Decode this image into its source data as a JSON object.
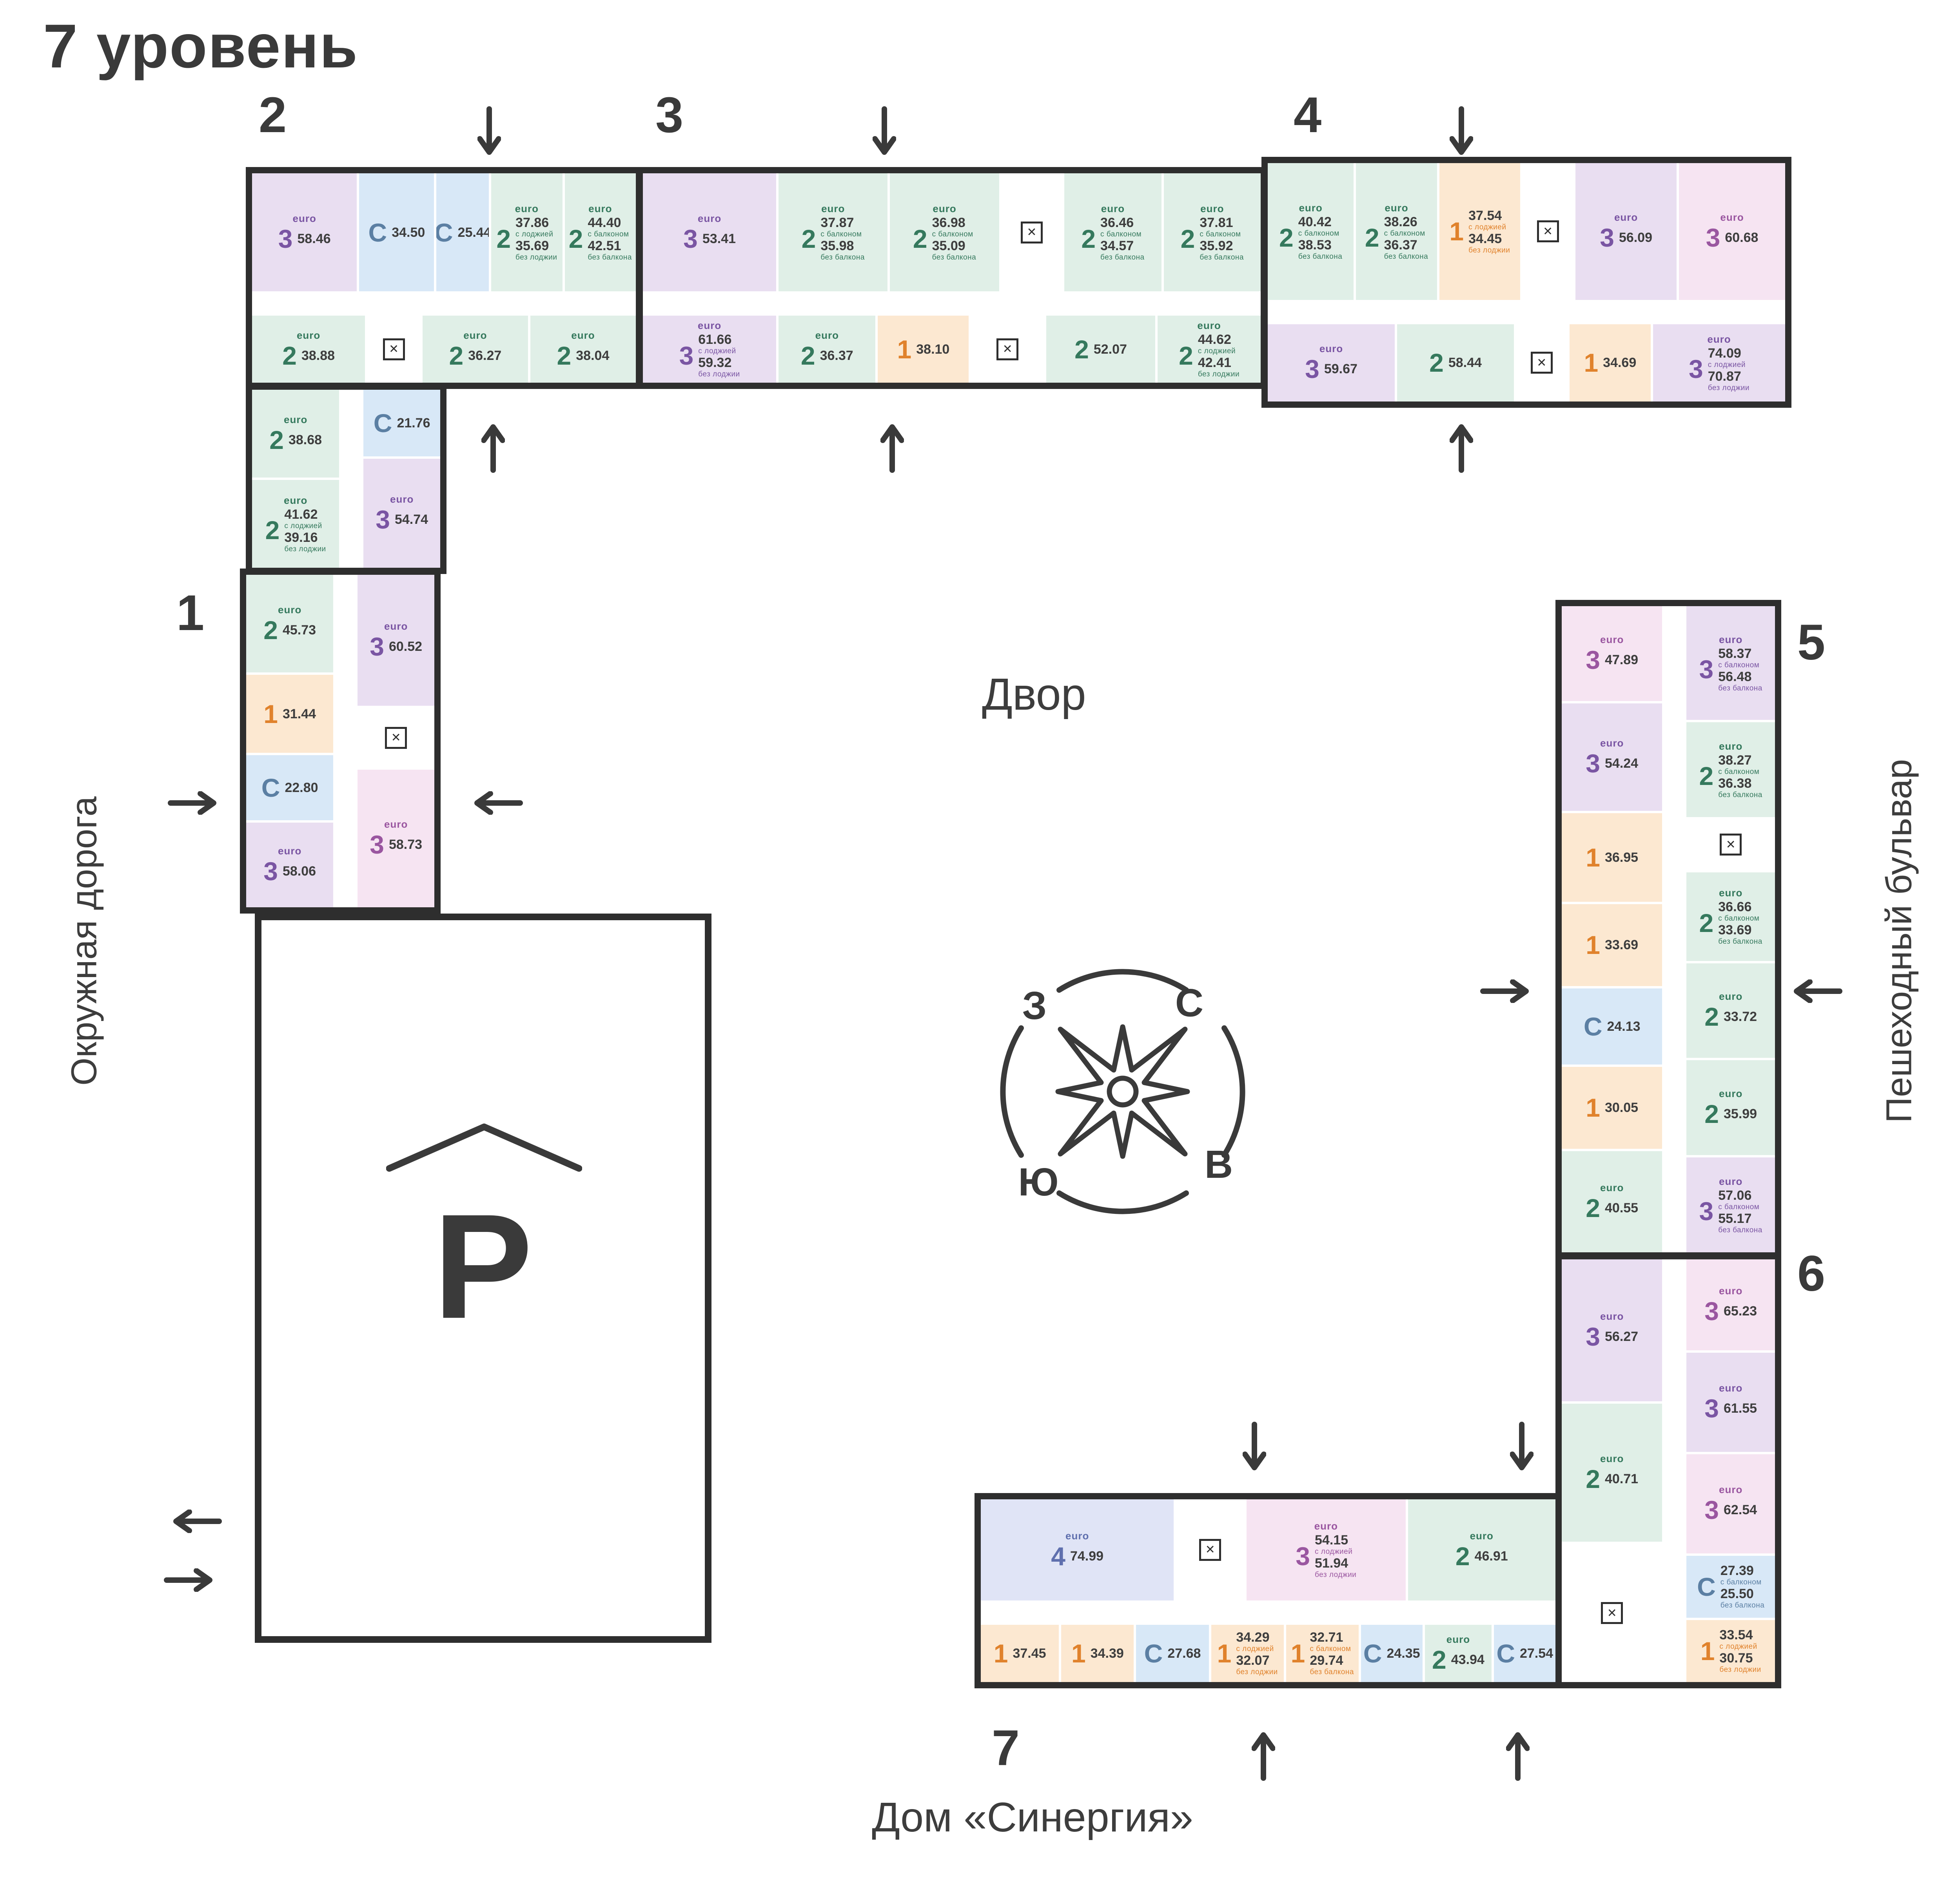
{
  "title": "7 уровень",
  "labels": {
    "courtyard": "Двор",
    "street_left": "Окружная дорога",
    "street_right": "Пешеходный бульвар",
    "house": "Дом «Синергия»",
    "parking": "P"
  },
  "compass": {
    "north": "С",
    "east": "В",
    "south": "Ю",
    "west": "З"
  },
  "section_numbers": {
    "s1": "1",
    "s2": "2",
    "s3": "3",
    "s4": "4",
    "s5": "5",
    "s6": "6",
    "s7": "7"
  },
  "colors": {
    "wall": "#2e2e2e",
    "text": "#3a3a3a",
    "apartment_purple": "#e9def1",
    "apartment_pink": "#f6e4f2",
    "apartment_green": "#e0efe7",
    "apartment_blue": "#d8e8f7",
    "apartment_orange": "#fce8d1",
    "apartment_periwinkle": "#e0e4f6",
    "type1": "#e0822c",
    "type2": "#35795d",
    "type3": "#7a55a3",
    "typeC": "#5b7fa3"
  },
  "cells": {
    "s2_outer": [
      {
        "t": "3",
        "euro": true,
        "c": "purple",
        "w": 28,
        "areas": [
          {
            "v": "58.46"
          }
        ]
      },
      {
        "t": "C",
        "c": "blue",
        "w": 20,
        "areas": [
          {
            "v": "34.50"
          }
        ]
      },
      {
        "t": "C",
        "c": "blue",
        "w": 14,
        "areas": [
          {
            "v": "25.44"
          }
        ]
      },
      {
        "t": "2",
        "euro": true,
        "c": "green",
        "w": 19,
        "areas": [
          {
            "v": "37.86",
            "sub": "с лоджией"
          },
          {
            "v": "35.69",
            "sub": "без лоджии"
          }
        ]
      },
      {
        "t": "2",
        "euro": true,
        "c": "green",
        "w": 19,
        "areas": [
          {
            "v": "44.40",
            "sub": "с балконом"
          },
          {
            "v": "42.51",
            "sub": "без балкона"
          }
        ]
      }
    ],
    "s2_inner": [
      {
        "t": "2",
        "euro": true,
        "c": "green",
        "w": 30,
        "areas": [
          {
            "v": "38.88"
          }
        ]
      },
      {
        "core": true,
        "w": 14
      },
      {
        "t": "2",
        "euro": true,
        "c": "green",
        "w": 28,
        "areas": [
          {
            "v": "36.27"
          }
        ]
      },
      {
        "t": "2",
        "euro": true,
        "c": "green",
        "w": 28,
        "areas": [
          {
            "v": "38.04"
          }
        ]
      }
    ],
    "s2leg_a": [
      {
        "t": "2",
        "euro": true,
        "c": "green",
        "w": 50,
        "areas": [
          {
            "v": "38.68"
          }
        ]
      },
      {
        "t": "2",
        "euro": true,
        "c": "green",
        "w": 50,
        "areas": [
          {
            "v": "41.62",
            "sub": "с лоджией"
          },
          {
            "v": "39.16",
            "sub": "без лоджии"
          }
        ]
      }
    ],
    "s2leg_b": [
      {
        "t": "C",
        "c": "blue",
        "w": 38,
        "areas": [
          {
            "v": "21.76"
          }
        ]
      },
      {
        "t": "3",
        "euro": true,
        "c": "purple",
        "w": 62,
        "areas": [
          {
            "v": "54.74"
          }
        ]
      }
    ],
    "s1_a": [
      {
        "t": "2",
        "euro": true,
        "c": "green",
        "w": 30,
        "areas": [
          {
            "v": "45.73"
          }
        ]
      },
      {
        "t": "1",
        "c": "orange",
        "w": 24,
        "areas": [
          {
            "v": "31.44"
          }
        ]
      },
      {
        "t": "C",
        "c": "blue",
        "w": 20,
        "areas": [
          {
            "v": "22.80"
          }
        ]
      },
      {
        "t": "3",
        "euro": true,
        "c": "purple",
        "w": 26,
        "areas": [
          {
            "v": "58.06"
          }
        ]
      }
    ],
    "s1_b": [
      {
        "t": "3",
        "euro": true,
        "c": "purple",
        "w": 40,
        "areas": [
          {
            "v": "60.52"
          }
        ]
      },
      {
        "core": true,
        "w": 18
      },
      {
        "t": "3",
        "euro": true,
        "c": "pink",
        "w": 42,
        "areas": [
          {
            "v": "58.73"
          }
        ]
      }
    ],
    "s3_outer": [
      {
        "t": "3",
        "euro": true,
        "c": "purple",
        "w": 22,
        "areas": [
          {
            "v": "53.41"
          }
        ]
      },
      {
        "t": "2",
        "euro": true,
        "c": "green",
        "w": 18,
        "areas": [
          {
            "v": "37.87",
            "sub": "с балконом"
          },
          {
            "v": "35.98",
            "sub": "без балкона"
          }
        ]
      },
      {
        "t": "2",
        "euro": true,
        "c": "green",
        "w": 18,
        "areas": [
          {
            "v": "36.98",
            "sub": "с балконом"
          },
          {
            "v": "35.09",
            "sub": "без балкона"
          }
        ]
      },
      {
        "core": true,
        "w": 10
      },
      {
        "t": "2",
        "euro": true,
        "c": "green",
        "w": 16,
        "areas": [
          {
            "v": "36.46",
            "sub": "с балконом"
          },
          {
            "v": "34.57",
            "sub": "без балкона"
          }
        ]
      },
      {
        "t": "2",
        "euro": true,
        "c": "green",
        "w": 16,
        "areas": [
          {
            "v": "37.81",
            "sub": "с балконом"
          },
          {
            "v": "35.92",
            "sub": "без балкона"
          }
        ]
      }
    ],
    "s3_inner": [
      {
        "t": "3",
        "euro": true,
        "c": "purple",
        "w": 22,
        "areas": [
          {
            "v": "61.66",
            "sub": "с лоджией"
          },
          {
            "v": "59.32",
            "sub": "без лоджии"
          }
        ]
      },
      {
        "t": "2",
        "euro": true,
        "c": "green",
        "w": 16,
        "areas": [
          {
            "v": "36.37"
          }
        ]
      },
      {
        "t": "1",
        "c": "orange",
        "w": 15,
        "areas": [
          {
            "v": "38.10"
          }
        ]
      },
      {
        "core": true,
        "w": 12
      },
      {
        "t": "2",
        "c": "green",
        "w": 18,
        "areas": [
          {
            "v": "52.07"
          }
        ]
      },
      {
        "t": "2",
        "euro": true,
        "c": "green",
        "w": 17,
        "areas": [
          {
            "v": "44.62",
            "sub": "с лоджией"
          },
          {
            "v": "42.41",
            "sub": "без лоджии"
          }
        ]
      }
    ],
    "s4_outer": [
      {
        "t": "2",
        "euro": true,
        "c": "green",
        "w": 17,
        "areas": [
          {
            "v": "40.42",
            "sub": "с балконом"
          },
          {
            "v": "38.53",
            "sub": "без балкона"
          }
        ]
      },
      {
        "t": "2",
        "euro": true,
        "c": "green",
        "w": 16,
        "areas": [
          {
            "v": "38.26",
            "sub": "с балконом"
          },
          {
            "v": "36.37",
            "sub": "без балкона"
          }
        ]
      },
      {
        "t": "1",
        "c": "orange",
        "w": 16,
        "areas": [
          {
            "v": "37.54",
            "sub": "с лоджией"
          },
          {
            "v": "34.45",
            "sub": "без лоджии"
          }
        ]
      },
      {
        "core": true,
        "w": 10
      },
      {
        "t": "3",
        "euro": true,
        "c": "purple",
        "w": 20,
        "areas": [
          {
            "v": "56.09"
          }
        ]
      },
      {
        "t": "3",
        "euro": true,
        "c": "pink",
        "w": 21,
        "areas": [
          {
            "v": "60.68"
          }
        ]
      }
    ],
    "s4_inner": [
      {
        "t": "3",
        "euro": true,
        "c": "purple",
        "w": 25,
        "areas": [
          {
            "v": "59.67"
          }
        ]
      },
      {
        "t": "2",
        "c": "green",
        "w": 23,
        "areas": [
          {
            "v": "58.44"
          }
        ]
      },
      {
        "core": true,
        "w": 10
      },
      {
        "t": "1",
        "c": "orange",
        "w": 16,
        "areas": [
          {
            "v": "34.69"
          }
        ]
      },
      {
        "t": "3",
        "euro": true,
        "c": "purple",
        "w": 26,
        "areas": [
          {
            "v": "74.09",
            "sub": "с лоджией"
          },
          {
            "v": "70.87",
            "sub": "без лоджии"
          }
        ]
      }
    ],
    "s5_a": [
      {
        "t": "3",
        "euro": true,
        "c": "pink",
        "w": 15,
        "areas": [
          {
            "v": "47.89"
          }
        ]
      },
      {
        "t": "3",
        "euro": true,
        "c": "purple",
        "w": 17,
        "areas": [
          {
            "v": "54.24"
          }
        ]
      },
      {
        "t": "1",
        "c": "orange",
        "w": 14,
        "areas": [
          {
            "v": "36.95"
          }
        ]
      },
      {
        "t": "1",
        "c": "orange",
        "w": 13,
        "areas": [
          {
            "v": "33.69"
          }
        ]
      },
      {
        "t": "C",
        "c": "blue",
        "w": 12,
        "areas": [
          {
            "v": "24.13"
          }
        ]
      },
      {
        "t": "1",
        "c": "orange",
        "w": 13,
        "areas": [
          {
            "v": "30.05"
          }
        ]
      },
      {
        "t": "2",
        "euro": true,
        "c": "green",
        "w": 16,
        "areas": [
          {
            "v": "40.55"
          }
        ]
      }
    ],
    "s5_b": [
      {
        "t": "3",
        "euro": true,
        "c": "purple",
        "w": 18,
        "areas": [
          {
            "v": "58.37",
            "sub": "с балконом"
          },
          {
            "v": "56.48",
            "sub": "без балкона"
          }
        ]
      },
      {
        "t": "2",
        "euro": true,
        "c": "green",
        "w": 15,
        "areas": [
          {
            "v": "38.27",
            "sub": "с балконом"
          },
          {
            "v": "36.38",
            "sub": "без балкона"
          }
        ]
      },
      {
        "core": true,
        "w": 8
      },
      {
        "t": "2",
        "euro": true,
        "c": "green",
        "w": 14,
        "areas": [
          {
            "v": "36.66",
            "sub": "с балконом"
          },
          {
            "v": "33.69",
            "sub": "без балкона"
          }
        ]
      },
      {
        "t": "2",
        "euro": true,
        "c": "green",
        "w": 15,
        "areas": [
          {
            "v": "33.72"
          }
        ]
      },
      {
        "t": "2",
        "euro": true,
        "c": "green",
        "w": 15,
        "areas": [
          {
            "v": "35.99"
          }
        ]
      },
      {
        "t": "3",
        "euro": true,
        "c": "purple",
        "w": 15,
        "areas": [
          {
            "v": "57.06",
            "sub": "с балконом"
          },
          {
            "v": "55.17",
            "sub": "без балкона"
          }
        ]
      }
    ],
    "s6_a": [
      {
        "t": "3",
        "euro": true,
        "c": "purple",
        "w": 34,
        "areas": [
          {
            "v": "56.27"
          }
        ]
      },
      {
        "t": "2",
        "euro": true,
        "c": "green",
        "w": 33,
        "areas": [
          {
            "v": "40.71"
          }
        ]
      },
      {
        "core": true,
        "w": 33
      }
    ],
    "s6_b": [
      {
        "t": "3",
        "euro": true,
        "c": "pink",
        "w": 22,
        "areas": [
          {
            "v": "65.23"
          }
        ]
      },
      {
        "t": "3",
        "euro": true,
        "c": "purple",
        "w": 24,
        "areas": [
          {
            "v": "61.55"
          }
        ]
      },
      {
        "t": "3",
        "euro": true,
        "c": "pink",
        "w": 24,
        "areas": [
          {
            "v": "62.54"
          }
        ]
      },
      {
        "t": "C",
        "c": "blue",
        "w": 15,
        "areas": [
          {
            "v": "27.39",
            "sub": "с балконом"
          },
          {
            "v": "25.50",
            "sub": "без балкона"
          }
        ]
      },
      {
        "t": "1",
        "c": "orange",
        "w": 15,
        "areas": [
          {
            "v": "33.54",
            "sub": "с лоджией"
          },
          {
            "v": "30.75",
            "sub": "без лоджии"
          }
        ]
      }
    ],
    "s7_outer": [
      {
        "t": "4",
        "euro": true,
        "c": "periwinkle",
        "w": 34,
        "areas": [
          {
            "v": "74.99"
          }
        ]
      },
      {
        "core": true,
        "w": 12
      },
      {
        "t": "3",
        "euro": true,
        "c": "pink",
        "w": 28,
        "areas": [
          {
            "v": "54.15",
            "sub": "с лоджией"
          },
          {
            "v": "51.94",
            "sub": "без лоджии"
          }
        ]
      },
      {
        "t": "2",
        "euro": true,
        "c": "green",
        "w": 26,
        "areas": [
          {
            "v": "46.91"
          }
        ]
      }
    ],
    "s7_inner": [
      {
        "t": "1",
        "c": "orange",
        "w": 14,
        "areas": [
          {
            "v": "37.45"
          }
        ]
      },
      {
        "t": "1",
        "c": "orange",
        "w": 13,
        "areas": [
          {
            "v": "34.39"
          }
        ]
      },
      {
        "t": "C",
        "c": "blue",
        "w": 13,
        "areas": [
          {
            "v": "27.68"
          }
        ]
      },
      {
        "t": "1",
        "c": "orange",
        "w": 13,
        "areas": [
          {
            "v": "34.29",
            "sub": "с лоджией"
          },
          {
            "v": "32.07",
            "sub": "без лоджии"
          }
        ]
      },
      {
        "t": "1",
        "c": "orange",
        "w": 13,
        "areas": [
          {
            "v": "32.71",
            "sub": "с балконом"
          },
          {
            "v": "29.74",
            "sub": "без балкона"
          }
        ]
      },
      {
        "t": "C",
        "c": "blue",
        "w": 11,
        "areas": [
          {
            "v": "24.35"
          }
        ]
      },
      {
        "t": "2",
        "euro": true,
        "c": "green",
        "w": 12,
        "areas": [
          {
            "v": "43.94"
          }
        ]
      },
      {
        "t": "C",
        "c": "blue",
        "w": 11,
        "areas": [
          {
            "v": "27.54"
          }
        ]
      }
    ]
  },
  "balconies": {
    "s2": [
      "1.89 балкон",
      "2.17 лоджия",
      "2.46 лоджия"
    ],
    "s3": [
      "1.89 балкон",
      "2.21 лоджия",
      "2.34 лоджия"
    ],
    "s4": [
      "1.89 балкон",
      "3.09 лоджия",
      "3.22 лоджия"
    ],
    "s5": [
      "1.89 балкон",
      "2.97 балкон"
    ],
    "s6": [
      "1.89 балкон",
      "2.79 лоджия"
    ],
    "s7": [
      "2.21 лоджия",
      "2.22 лоджия",
      "2.97 балкон",
      "1.89 балкон"
    ]
  }
}
